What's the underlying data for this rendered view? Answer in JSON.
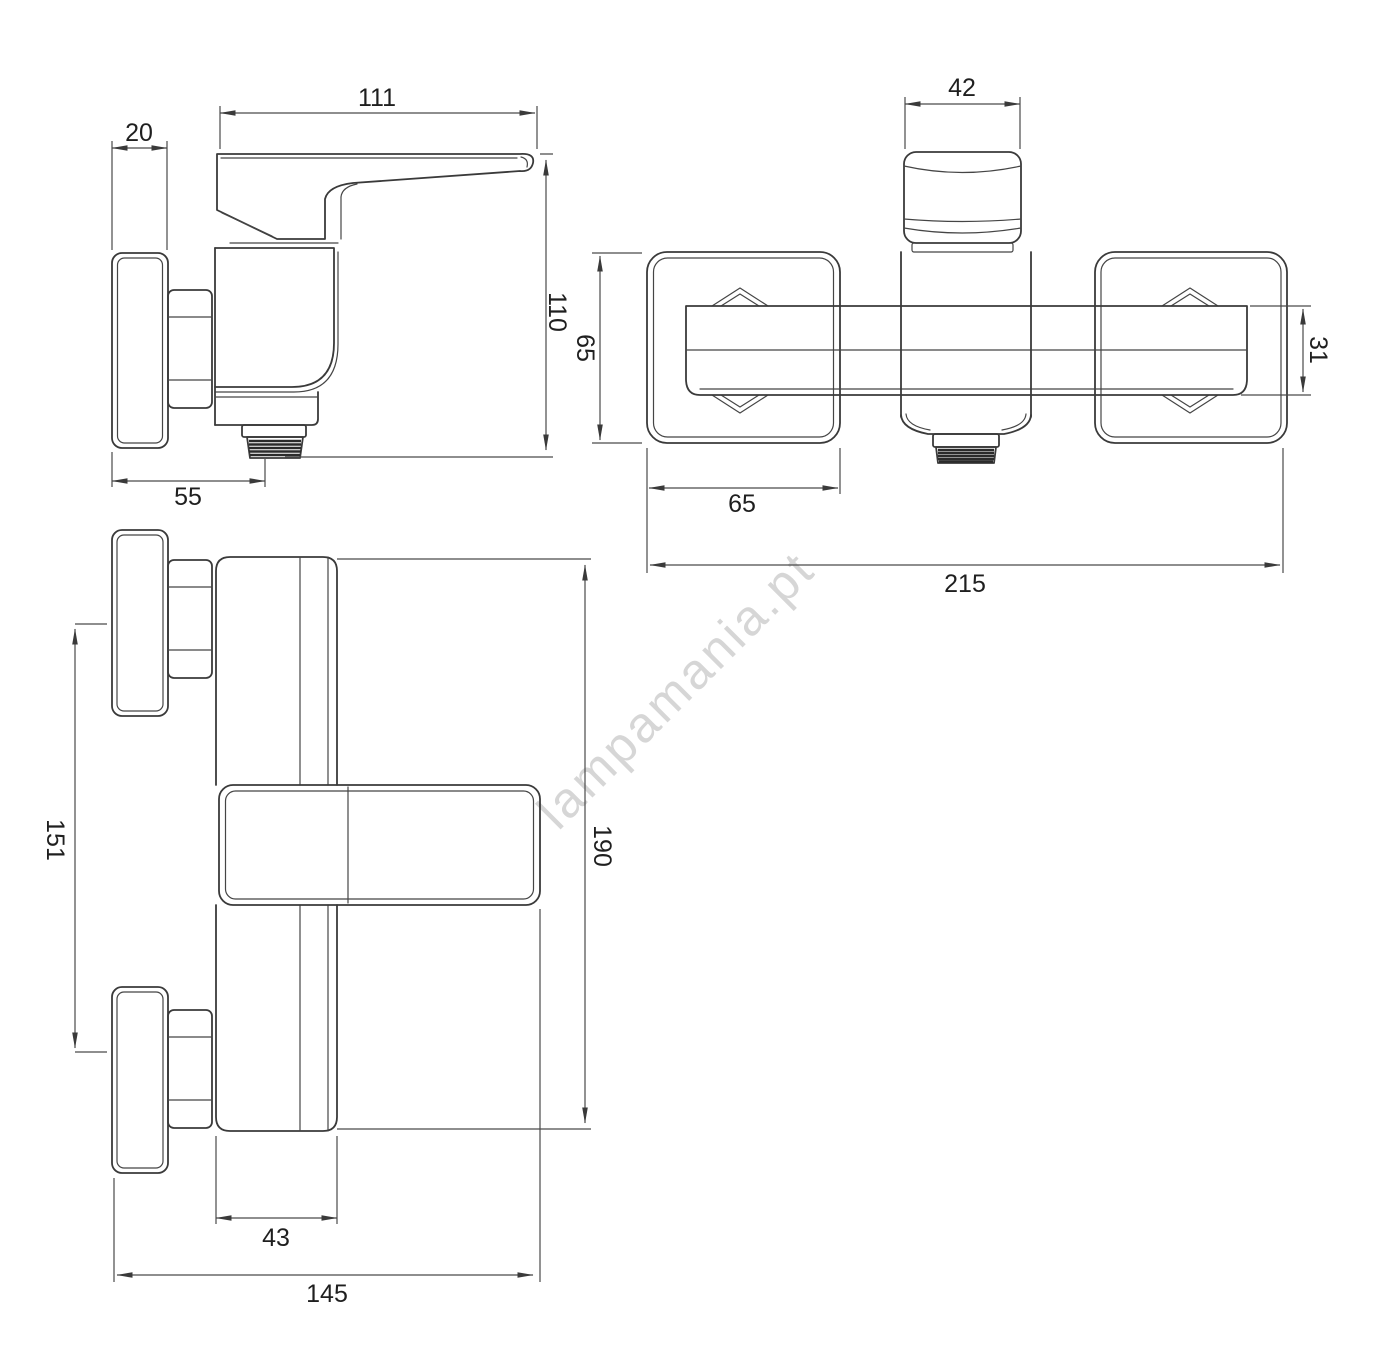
{
  "watermark": {
    "text": "lampamania.pt"
  },
  "drawing": {
    "line_color": "#3a3a3a",
    "dim_line_color": "#4a4a4a",
    "text_color": "#1f1f1f",
    "watermark_color": "#d6d6d6",
    "background": "#ffffff"
  },
  "views": {
    "side": {
      "dims": {
        "handle_length": "111",
        "wall_plate_thickness": "20",
        "total_height": "110",
        "outlet_depth": "55"
      }
    },
    "front": {
      "dims": {
        "handle_width": "42",
        "wall_plate_height": "65",
        "crossbar_height": "31",
        "wall_plate_width": "65",
        "total_width": "215"
      }
    },
    "top": {
      "dims": {
        "connection_spacing": "151",
        "overall_depth": "190",
        "body_width": "43",
        "overall_length": "145"
      }
    }
  }
}
